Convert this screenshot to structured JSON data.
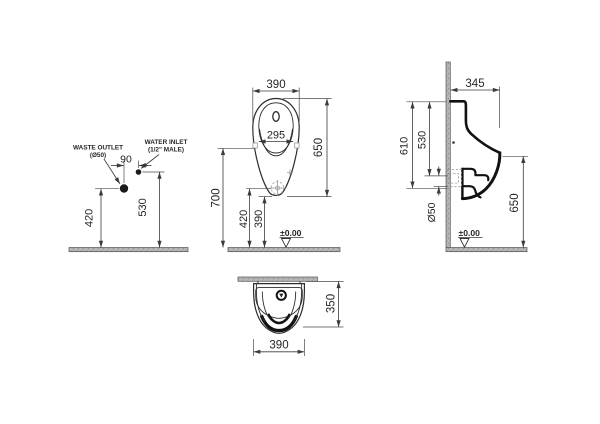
{
  "page": {
    "background": "#ffffff"
  },
  "colors": {
    "line": "#3a3a3a",
    "profile": "#111111",
    "concrete_fill": "#b5b5b5"
  },
  "connection_view": {
    "waste_outlet_label_line1": "WASTE OUTLET",
    "waste_outlet_label_line2": "(Ø50)",
    "water_inlet_label_line1": "WATER INLET",
    "water_inlet_label_line2": "(1/2\" MALE)",
    "dim_inlet_offset": "90",
    "dim_waste_outlet_height": "420",
    "dim_water_inlet_height": "530"
  },
  "front_view": {
    "dim_width": "390",
    "dim_rim_opening": "295",
    "dim_body_height": "650",
    "dim_fixing_height": "700",
    "dim_trap_height": "420",
    "dim_bottom_height": "390",
    "datum_level": "±0.00"
  },
  "side_view": {
    "dim_depth": "345",
    "dim_rim_to_outlet": "610",
    "dim_rim_to_inlet": "530",
    "dim_front_edge_height": "650",
    "dim_outlet_diameter": "Ø50",
    "datum_level": "±0.00"
  },
  "top_view": {
    "dim_depth": "350",
    "dim_width": "390"
  }
}
